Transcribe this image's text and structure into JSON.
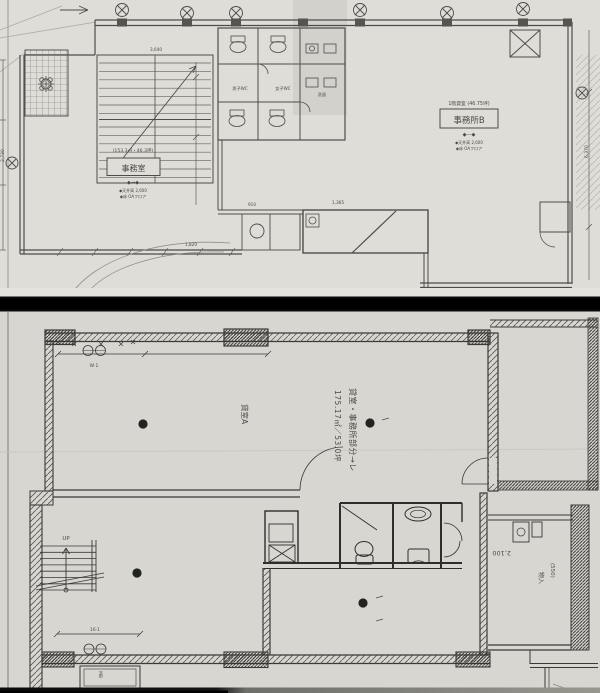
{
  "colors": {
    "paper_top": "#deddd8",
    "paper_bottom": "#d7d6d1",
    "ink_top": "#4e4d49",
    "ink_bottom": "#3a3936",
    "separator": "#0b0b0b",
    "column_dot": "#232320"
  },
  "top_plan": {
    "left_room": {
      "area": "(153.3㎡・46.3坪)",
      "label": "事務室",
      "marker": "◆→◆",
      "note1": "◆天井高 2,600",
      "note2": "◆床 OAフロア"
    },
    "right_room": {
      "heading": "1階貸室 (46.75坪)",
      "label": "事務所B",
      "marker": "◆—◆",
      "note1": "◆天井高 2,600",
      "note2": "◆床 OAフロア"
    },
    "wc": {
      "label1": "男子WC",
      "label2": "女子WC",
      "label3": "洗面"
    },
    "dims": {
      "d1": "2,730",
      "d2": "1,820",
      "d3": "910",
      "d4": "6,370",
      "d5": "3,640",
      "d6": "1,365"
    }
  },
  "bottom_plan": {
    "note_line1": "貸室・事務所部分→レ",
    "note_line2": "175.17㎡／53.0坪",
    "tenant_label": "貸室A",
    "stair_label": "UP",
    "storage_label": "物入",
    "meter_box": "MB",
    "dims": {
      "d2100": "2,100",
      "d550": "(550)",
      "w1": "W·1",
      "d161": "16·1"
    }
  }
}
